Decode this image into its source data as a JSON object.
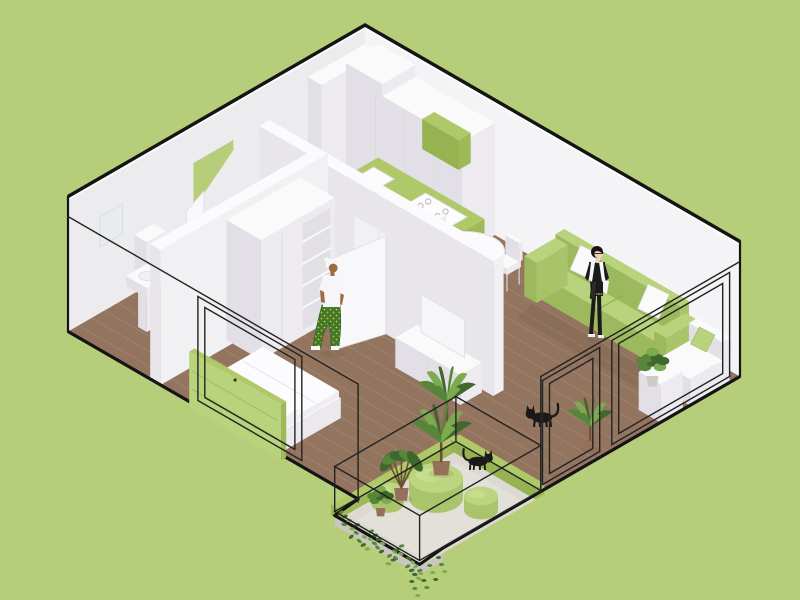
{
  "scene": {
    "type": "isometric-apartment-cutaway-render",
    "description": "Axonometric cutaway of a small apartment with green accent furniture, wood floors, two residents and two black cats",
    "rooms": [
      {
        "name": "kitchen"
      },
      {
        "name": "dining-area"
      },
      {
        "name": "living-room"
      },
      {
        "name": "bedroom"
      },
      {
        "name": "bathroom"
      },
      {
        "name": "entry-hall"
      },
      {
        "name": "balcony-terrace"
      }
    ],
    "objects": [
      "tall-kitchen-cabinets",
      "green-kitchen-counter",
      "kitchen-sink",
      "cooktop",
      "round-dining-table",
      "four-white-chairs",
      "green-sofa",
      "white-pillows",
      "tv-sideboard",
      "tv-panel",
      "double-bed",
      "green-headboard",
      "open-wardrobe",
      "toilet",
      "pedestal-washbasin",
      "mirror",
      "chaise-lounge",
      "cube-side-table",
      "green-poufs",
      "potted-plants",
      "trailing-ivy",
      "glass-wall-wireframes",
      "balcony-railing"
    ],
    "people": [
      {
        "name": "woman-walking",
        "location": "bedroom",
        "outfit": "white tee, patterned green trousers, white head wrap"
      },
      {
        "name": "woman-standing",
        "location": "living-room",
        "outfit": "black top and trousers, glasses, holding a book"
      }
    ],
    "animals": [
      {
        "name": "cat-living-room",
        "color": "black"
      },
      {
        "name": "cat-balcony",
        "color": "black"
      }
    ],
    "colors": {
      "background": "#b6ce79",
      "outline": "#141414",
      "wire": "#232323",
      "wood": "#93745f",
      "wood_line": "rgba(255,255,255,0.10)",
      "concrete": "#dcd9d3",
      "concrete_light": "#e6e3dd",
      "concrete_edge": "#c9c6bf",
      "wall_left": "#ecebee",
      "wall_right": "#f4f3f6",
      "white_top": "#fafafa",
      "white_side_a": "#edebf0",
      "white_side_b": "#e2e0e6",
      "seam": "#dcdade",
      "green_top": "#afc968",
      "green_side_a": "#9eba57",
      "green_side_b": "#96b251",
      "sofa_top": "#b9d27c",
      "sofa_side_a": "#a9c468",
      "sofa_side_b": "#9db95e",
      "pouf_top": "#bdd581",
      "pouf_side": "#a9c46a",
      "plant_dark": "#3f672e",
      "plant_mid": "#57863a",
      "plant_light": "#7cab4f",
      "pot_terracotta": "#96705a",
      "pot_white": "#cfccc6",
      "stem": "#6b5033",
      "cat": "#191919",
      "skin_dark": "#9c6b3f",
      "skin_light": "#ecd0b0",
      "fabric_black": "#1b1b1d",
      "fabric_white": "#f6f5f8",
      "pants_green": "#3c7a2c",
      "pants_dot": "#e09a1e",
      "shadow": "rgba(70,70,45,0.12)"
    }
  }
}
